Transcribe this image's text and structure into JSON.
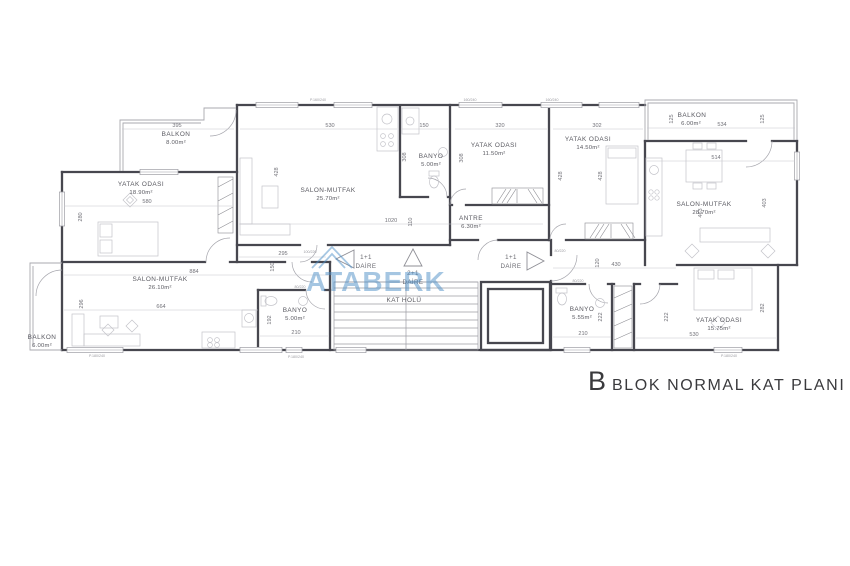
{
  "title": {
    "prefix": "B",
    "text": "BLOK NORMAL KAT PLANI"
  },
  "watermark": {
    "brand": "ATABERK"
  },
  "units": [
    {
      "size": "1+1",
      "word": "DAİRE"
    },
    {
      "size": "2+1",
      "word": "DAİRE"
    },
    {
      "size": "1+1",
      "word": "DAİRE"
    }
  ],
  "rooms": [
    {
      "name": "BALKON",
      "area": "8.00m²"
    },
    {
      "name": "YATAK ODASI",
      "area": "18.90m²"
    },
    {
      "name": "SALON-MUTFAK",
      "area": "25.70m²"
    },
    {
      "name": "BANYO",
      "area": "5.00m²"
    },
    {
      "name": "YATAK ODASI",
      "area": "11.50m²"
    },
    {
      "name": "YATAK ODASI",
      "area": "14.50m²"
    },
    {
      "name": "ANTRE",
      "area": "6.30m²"
    },
    {
      "name": "BALKON",
      "area": "6.00m²"
    },
    {
      "name": "SALON-MUTFAK",
      "area": "28.70m²"
    },
    {
      "name": "SALON-MUTFAK",
      "area": "26.10m²"
    },
    {
      "name": "BALKON",
      "area": "6.00m²"
    },
    {
      "name": "BANYO",
      "area": "5.00m²"
    },
    {
      "name": "KAT HOLÜ",
      "area": ""
    },
    {
      "name": "BANYO",
      "area": "5.55m²"
    },
    {
      "name": "YATAK ODASI",
      "area": "15.75m²"
    }
  ],
  "dims": [
    {
      "v": "395"
    },
    {
      "v": "580"
    },
    {
      "v": "280"
    },
    {
      "v": "530"
    },
    {
      "v": "428"
    },
    {
      "v": "150"
    },
    {
      "v": "308"
    },
    {
      "v": "320"
    },
    {
      "v": "308"
    },
    {
      "v": "302"
    },
    {
      "v": "428"
    },
    {
      "v": "428"
    },
    {
      "v": "1020"
    },
    {
      "v": "110"
    },
    {
      "v": "125"
    },
    {
      "v": "534"
    },
    {
      "v": "125"
    },
    {
      "v": "514"
    },
    {
      "v": "463"
    },
    {
      "v": "403"
    },
    {
      "v": "884"
    },
    {
      "v": "664"
    },
    {
      "v": "296"
    },
    {
      "v": "295"
    },
    {
      "v": "150"
    },
    {
      "v": "192"
    },
    {
      "v": "210"
    },
    {
      "v": "430"
    },
    {
      "v": "120"
    },
    {
      "v": "222"
    },
    {
      "v": "222"
    },
    {
      "v": "282"
    },
    {
      "v": "530"
    },
    {
      "v": "210"
    }
  ],
  "tags": [
    {
      "v": "P.160/240"
    },
    {
      "v": "160/240"
    },
    {
      "v": "160/240"
    },
    {
      "v": "100/220"
    },
    {
      "v": "80/220"
    },
    {
      "v": "80/220"
    },
    {
      "v": "80/220"
    },
    {
      "v": "P.180/240"
    },
    {
      "v": "P.180/240"
    },
    {
      "v": "P.180/240"
    }
  ]
}
